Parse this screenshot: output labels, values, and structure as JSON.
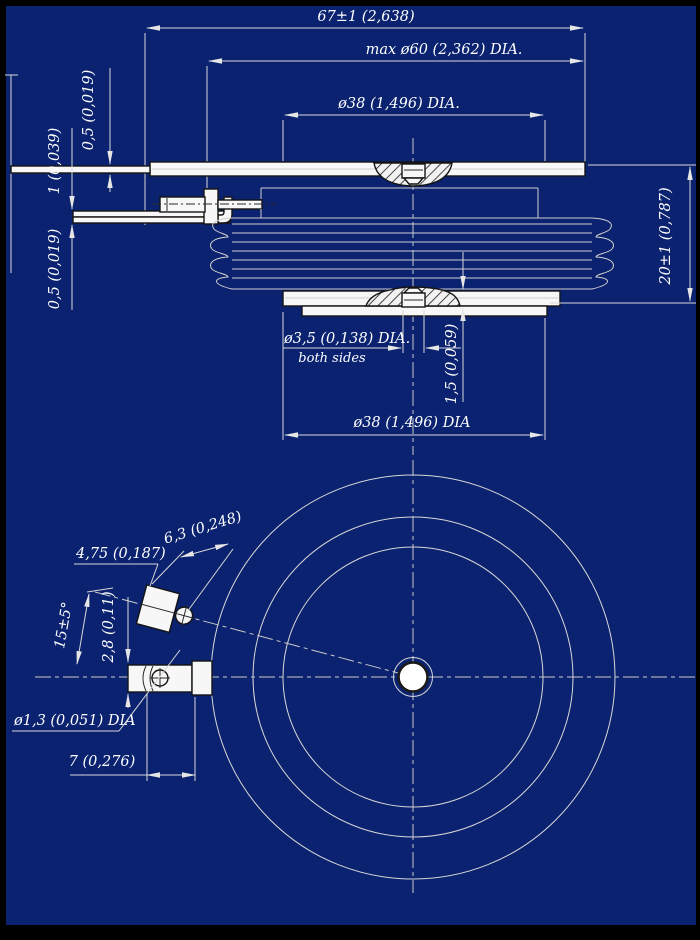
{
  "drawing": {
    "type": "engineering drawing, disc (puck) semiconductor package, section and bottom view",
    "colors": {
      "background": "#0a226f",
      "frame": "#000000",
      "line_light": "#d8d8d8",
      "part_fill": "#f7f7f7",
      "part_outline": "#141414",
      "text": "#ffffff"
    },
    "front": {
      "dim67": "67±1 (2,638)",
      "dim60": "max ø60 (2,362) DIA.",
      "dim38_top": "ø38 (1,496) DIA.",
      "thk_top": "0,5 (0,019)",
      "thk_mid": "1 (0,039)",
      "thk_bot": "0,5 (0,019)",
      "height": "20±1 (0,787)",
      "gate_hole": "ø3,5 (0,138) DIA.",
      "gate_hole_note": "both sides",
      "boss_height": "1,5 (0,059)",
      "dim38_bottom": "ø38 (1,496) DIA"
    },
    "plan": {
      "block_width": "4,75 (0,187)",
      "block_length": "6,3 (0,248)",
      "lead_angle": "15±5°",
      "lead_offset": "2,8 (0,11)",
      "hole_dia": "ø1,3 (0,051) DIA",
      "tip_length": "7 (0,276)"
    }
  }
}
